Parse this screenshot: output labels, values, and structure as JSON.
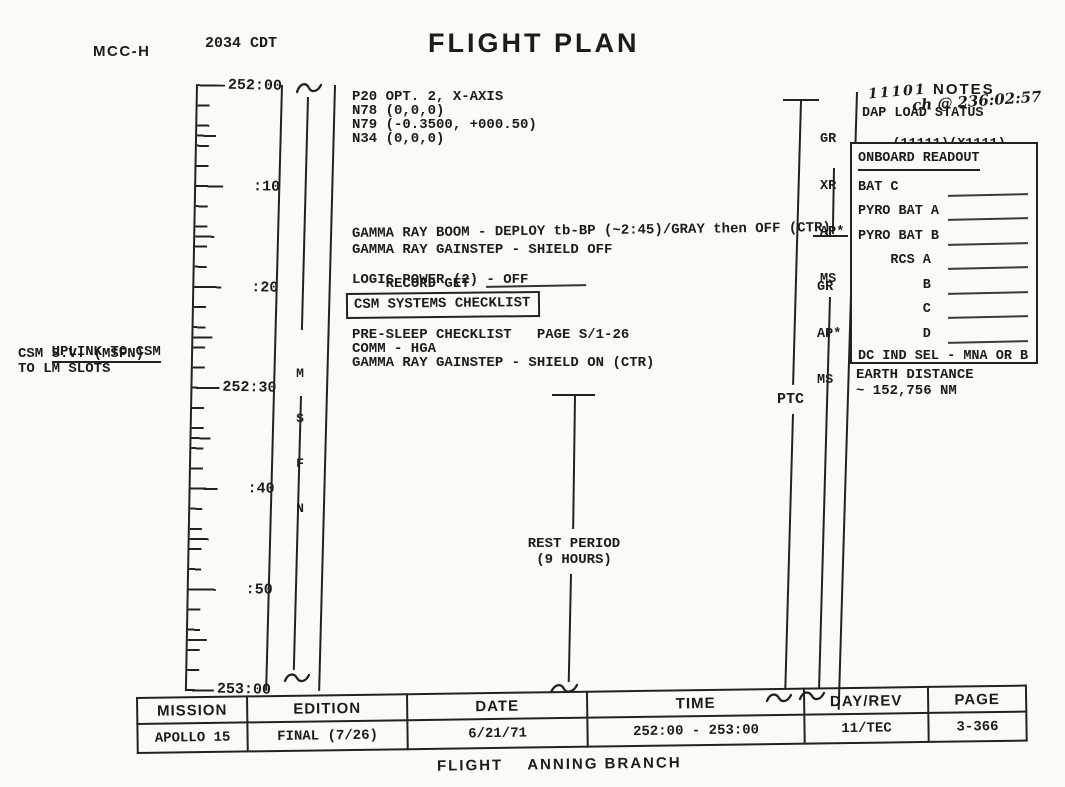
{
  "colors": {
    "ink": "#1c1c1c",
    "paper": "#fbfaf6"
  },
  "header": {
    "station": "MCC-H",
    "clock": "2034 CDT",
    "title": "FLIGHT PLAN"
  },
  "timeline": {
    "labels": [
      "252:00",
      ":10",
      ":20",
      "252:30",
      ":40",
      ":50",
      "253:00"
    ]
  },
  "msfn": {
    "letters": [
      "M",
      "S",
      "F",
      "N"
    ]
  },
  "left_notes": {
    "line1": "UPLINK TO CSM",
    "line2": "CSM S.V. (MSFN)",
    "line3": "TO LM SLOTS"
  },
  "procedures": {
    "p20": [
      "P20 OPT. 2, X-AXIS",
      "N78 (0,0,0)",
      "N79 (-0.3500, +000.50)",
      "N34 (0,0,0)"
    ],
    "gamma": [
      "GAMMA RAY BOOM - DEPLOY tb-BP (~2:45)/GRAY then OFF (CTR)",
      "GAMMA RAY GAINSTEP - SHIELD OFF",
      "RECORD GET",
      "LOGIC POWER (2) - OFF"
    ],
    "boxed_checklist": "CSM SYSTEMS CHECKLIST",
    "presleep": [
      "PRE-SLEEP CHECKLIST   PAGE S/1-26",
      "COMM - HGA",
      "GAMMA RAY GAINSTEP - SHIELD ON (CTR)"
    ],
    "rest_period": {
      "line1": "REST PERIOD",
      "line2": "(9 HOURS)"
    }
  },
  "attitude": {
    "ptc_label": "PTC",
    "group1": [
      "GR",
      "XR",
      "AP*",
      "MS"
    ],
    "group2": [
      "GR",
      "AP*",
      "MS"
    ]
  },
  "notes": {
    "header": "NOTES",
    "handwritten_1": "11101",
    "handwritten_2": "ch @ 236:02:57",
    "dap_title": "DAP LOAD STATUS",
    "dap_old": "(11111)",
    "dap_new": "(X1111)",
    "onboard": {
      "title": "ONBOARD READOUT",
      "rows": [
        "BAT C",
        "PYRO BAT A",
        "PYRO BAT B",
        "    RCS A",
        "        B",
        "        C",
        "        D"
      ],
      "footer": "DC IND SEL - MNA OR B"
    },
    "earth_distance": {
      "line1": "EARTH DISTANCE",
      "line2": "~ 152,756 NM"
    }
  },
  "footer_table": {
    "columns": [
      {
        "header": "MISSION",
        "value": "APOLLO 15"
      },
      {
        "header": "EDITION",
        "value": "FINAL (7/26)"
      },
      {
        "header": "DATE",
        "value": "6/21/71"
      },
      {
        "header": "TIME",
        "value": "252:00 - 253:00"
      },
      {
        "header": "DAY/REV",
        "value": "11/TEC"
      },
      {
        "header": "PAGE",
        "value": "3-366"
      }
    ],
    "caption": "FLIGHT    ANNING BRANCH"
  }
}
